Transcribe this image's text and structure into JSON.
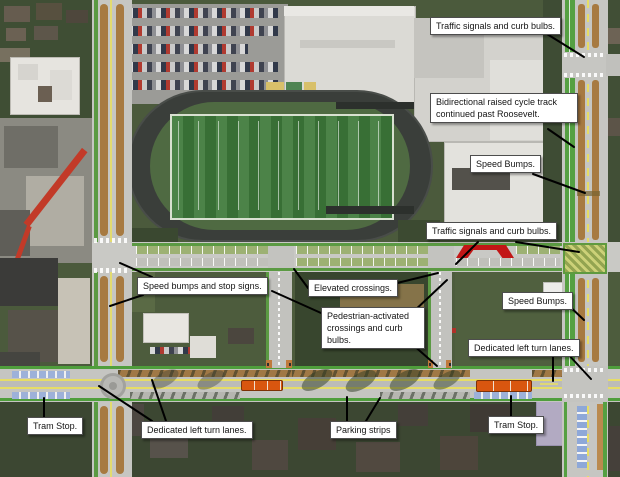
{
  "annotations": [
    {
      "name": "traffic-signals-north",
      "text": "Traffic signals and curb bulbs.",
      "x": 430,
      "y": 17,
      "arrows": [
        [
          547,
          34,
          584,
          57
        ]
      ]
    },
    {
      "name": "cycle-track",
      "text": "Bidirectional raised cycle track continued past Roosevelt.",
      "x": 430,
      "y": 93,
      "w": 136,
      "arrows": [
        [
          548,
          129,
          574,
          147
        ]
      ]
    },
    {
      "name": "speed-bumps-north",
      "text": "Speed Bumps.",
      "x": 470,
      "y": 155,
      "arrows": [
        [
          533,
          174,
          585,
          193
        ]
      ]
    },
    {
      "name": "traffic-signals-mid",
      "text": "Traffic signals and curb bulbs.",
      "x": 426,
      "y": 222,
      "arrows": [
        [
          516,
          242,
          579,
          252
        ],
        [
          478,
          242,
          456,
          264
        ]
      ]
    },
    {
      "name": "speed-bumps-stop-signs",
      "text": "Speed bumps and stop signs.",
      "x": 137,
      "y": 277,
      "arrows": [
        [
          152,
          277,
          120,
          263
        ],
        [
          143,
          295,
          110,
          306
        ]
      ]
    },
    {
      "name": "elevated-crossings",
      "text": "Elevated crossings.",
      "x": 308,
      "y": 279,
      "arrows": [
        [
          308,
          288,
          294,
          269
        ],
        [
          393,
          284,
          438,
          273
        ]
      ]
    },
    {
      "name": "speed-bumps-east",
      "text": "Speed Bumps.",
      "x": 502,
      "y": 292,
      "arrows": [
        [
          565,
          302,
          584,
          320
        ]
      ]
    },
    {
      "name": "pedestrian-crossings",
      "text": "Pedestrian-activated crossings and curb bulbs.",
      "x": 321,
      "y": 307,
      "w": 92,
      "arrows": [
        [
          321,
          313,
          272,
          291
        ],
        [
          412,
          313,
          447,
          280
        ],
        [
          412,
          344,
          437,
          366
        ]
      ]
    },
    {
      "name": "left-turn-lanes-east",
      "text": "Dedicated left turn lanes.",
      "x": 468,
      "y": 339,
      "arrows": [
        [
          553,
          355,
          553,
          381
        ],
        [
          566,
          352,
          591,
          379
        ]
      ]
    },
    {
      "name": "tram-stop-west",
      "text": "Tram Stop.",
      "x": 27,
      "y": 417,
      "arrows": [
        [
          44,
          417,
          44,
          398
        ]
      ]
    },
    {
      "name": "left-turn-lanes-west",
      "text": "Dedicated left turn lanes.",
      "x": 141,
      "y": 421,
      "arrows": [
        [
          152,
          421,
          99,
          386
        ],
        [
          166,
          421,
          152,
          380
        ]
      ]
    },
    {
      "name": "parking-strips",
      "text": "Parking strips",
      "x": 330,
      "y": 421,
      "arrows": [
        [
          347,
          421,
          347,
          397
        ],
        [
          366,
          421,
          380,
          398
        ]
      ]
    },
    {
      "name": "tram-stop-east",
      "text": "Tram Stop.",
      "x": 488,
      "y": 416,
      "arrows": [
        [
          511,
          416,
          511,
          396
        ]
      ]
    }
  ],
  "overlay_colors": {
    "cycle_track_green": "#55a042",
    "street_edge_green": "#4f9e3c",
    "lane_brown": "#a77a41",
    "center_line_yellow": "#e6dd66",
    "tram_orange": "#d9560f",
    "parking_stall_blue": "#9db1d9",
    "speed_table_red": "#c21616",
    "elevated_crossing_green": "#ccd178",
    "pavement_gray": "#c6c6c2",
    "annotation_line_black": "#000000"
  }
}
